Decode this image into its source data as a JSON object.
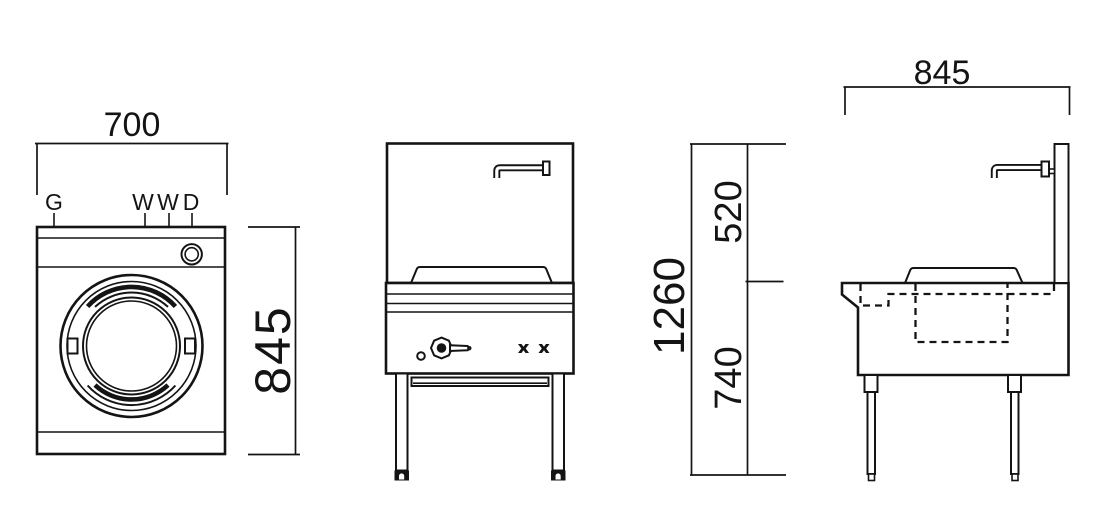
{
  "drawing": {
    "background": "#ffffff",
    "line_color": "#141414",
    "views": {
      "plan": "plan-view",
      "front": "front-elevation-view",
      "side": "side-elevation-view"
    },
    "dimensions": {
      "plan_width": "700",
      "plan_depth": "845",
      "side_width": "845",
      "overall_height": "1260",
      "upper_height": "520",
      "lower_height": "740"
    },
    "connection_labels": {
      "gas": "G",
      "hot_water": "W",
      "cold_water": "W",
      "drain": "D"
    }
  }
}
